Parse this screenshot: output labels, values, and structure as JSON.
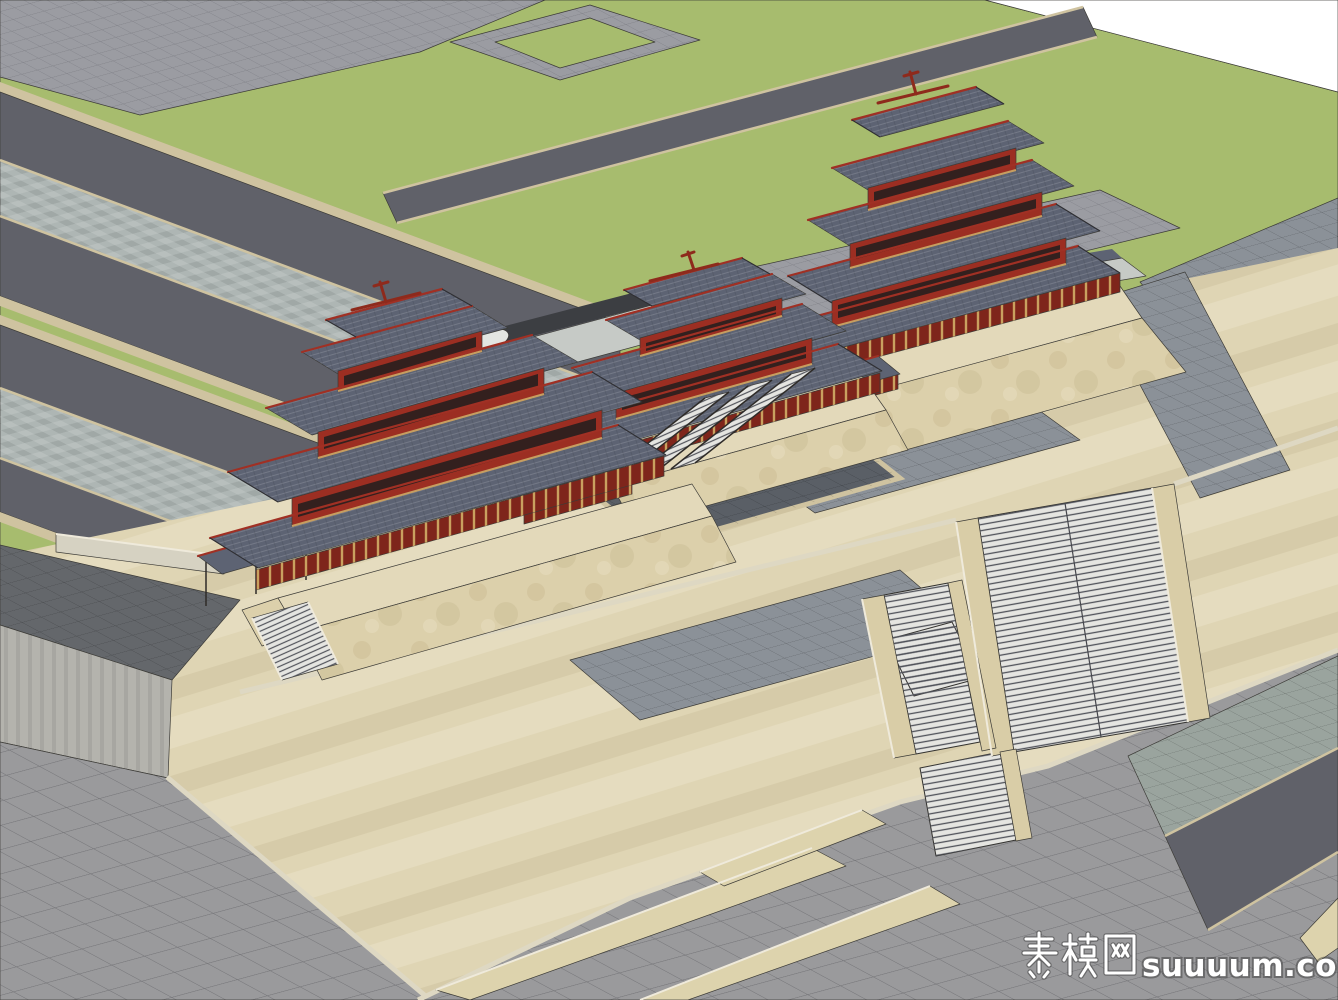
{
  "watermark": {
    "text": "素模网suuuum.com",
    "cjk": "素模网",
    "latin": "suuuum.com"
  },
  "palette": {
    "sky": "#ffffff",
    "lawn": "#a7bc6e",
    "plaza_gray": "#9b9ca2",
    "road_dark": "#606169",
    "canal_gray": "#aeb6b4",
    "curb_tan": "#cfc3a0",
    "beige": "#dfd5b4",
    "lower_gray": "#9a9a9c",
    "stone_green": "#9aa49e",
    "terrace_dark": "#64676b",
    "stone_wall": "#b4b3ad",
    "stair_light": "#e5e5e1",
    "ramp_tan": "#d9cda7",
    "walkway_tan": "#ddd3ad",
    "gray_field": "#8b9198",
    "dark_inlay": "#5a5f66",
    "roof_slate": "#5d6373",
    "wall_red": "#9c2e22",
    "colonnade_dark": "#7e251b",
    "podium_tan": "#e3d9ba",
    "podium_slope": "#dcd0ab",
    "bridge_pale": "#c6cac6",
    "wood": "#c9a164"
  }
}
